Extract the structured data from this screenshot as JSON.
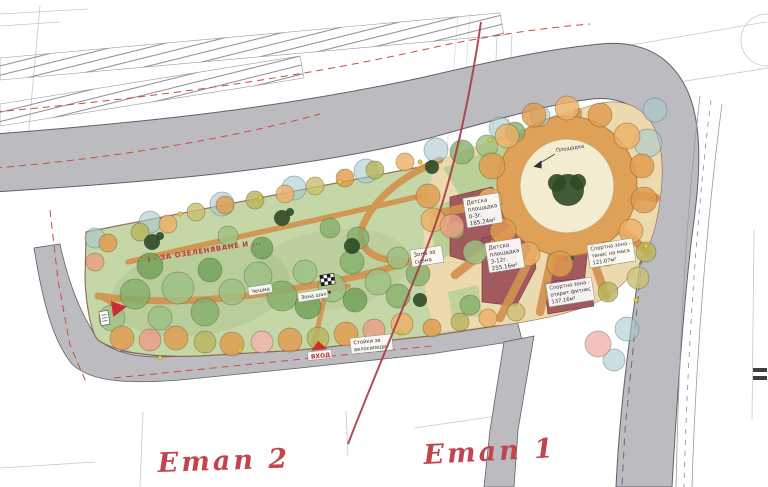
{
  "plan": {
    "stages": {
      "stage1": "Етап 1",
      "stage2": "Етап 2"
    },
    "notes": {
      "greening": "I - ЗА ОЗЕЛЕНЯВАНЕ И ...",
      "plaza": "Площадка"
    },
    "zones": {
      "playground_small": {
        "l1": "Детска",
        "l2": "площадка",
        "l3": "0-3г.",
        "area": "185.24м²"
      },
      "playground_big": {
        "l1": "Детска",
        "l2": "площадка",
        "l3": "3-12г.",
        "area": "255.16м²"
      },
      "sport_tennis": {
        "l1": "Спортна зона -",
        "l2": "тенис на маса",
        "area": "121.07м²"
      },
      "sport_fitness": {
        "l1": "Спортна зона -",
        "l2": "открит фитнес",
        "area": "137.16м²"
      },
      "stage_zone": {
        "l1": "Зона за",
        "l2": "сцена"
      },
      "chess": {
        "label": "Зона шах"
      },
      "fountain": {
        "label": "Чешма"
      },
      "bike_racks": {
        "l1": "Стойки за",
        "l2": "велосипеди"
      },
      "entrance": {
        "label": "ВХОД"
      }
    },
    "icons": {
      "entrance_arrow": "red-triangle",
      "chess_board": "checkerboard",
      "plaza_arrow": "curved-arrow",
      "info_sign": "small-white-sign"
    },
    "colors": {
      "park_green": "#c6d7a7",
      "road_gray": "#bcbcc0",
      "path_tan": "#d1924f",
      "zone_maroon": "#9c4f58",
      "plaza_ring": "#dfa058",
      "plaza_center": "#f3ecd0",
      "annotation_red": "#c2454e",
      "boundary_dash_red": "#cd4a42"
    }
  }
}
